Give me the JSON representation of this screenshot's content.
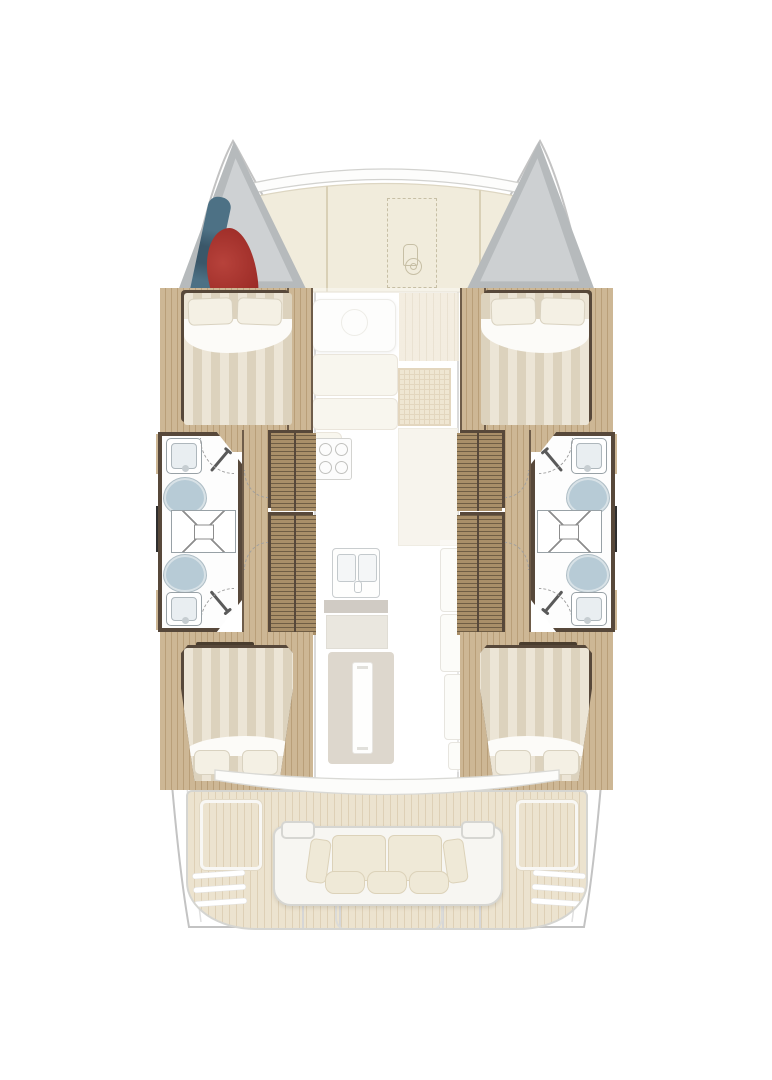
{
  "diagram": {
    "type": "floor-plan",
    "subject": "sailing-catamaran interior layout, top view, bow up",
    "hull_elements": [
      "bow-stowage-locker",
      "forward-double-berth",
      "forward-head-sink",
      "forward-toilet",
      "central-shower",
      "aft-toilet",
      "aft-head-sink",
      "wardrobe-lockers",
      "companionway-walkway",
      "aft-double-berth"
    ],
    "port_bow_locker_contents": [
      "stowed-sail-blue",
      "sail-bag-red"
    ],
    "centerline_elements": [
      "foredeck-sunpads",
      "trampoline-outline",
      "anchor-windlass",
      "forward-cockpit-table",
      "salon-settee",
      "galley-stove",
      "galley-double-sink",
      "galley-counter",
      "dining-table-with-leaf",
      "storage-cabinets",
      "aft-cockpit-bench",
      "engine-hatches",
      "transom-steps",
      "swim-platforms"
    ],
    "counts": {
      "cabins": 4,
      "toilets": 4,
      "sinks": 4,
      "showers": 2,
      "double_beds": 4,
      "bench_seat_cushions": 3,
      "bench_back_cushions": 2
    }
  },
  "colors": {
    "hull_outline": "#c3c3c3",
    "hull_seam": "#e0e0e0",
    "hull_fill": "#ffffff",
    "bow_locker": "#b6babc",
    "bow_locker_inner": "#ced1d3",
    "sail_bag_red": "#9e2d28",
    "sail_bag_red_dark": "#76201c",
    "gear_blue": "#4d7185",
    "gear_blue_dark": "#3a5769",
    "sunpad": "#f1ecdc",
    "sunpad_line": "#d9d0b6",
    "dash_outline": "#c7bfa5",
    "teak": "#e9dec6",
    "teak_line": "#d8c8a9",
    "wood": "#cdb795",
    "wood_line": "#b99f79",
    "dark_wood": "#57483a",
    "dark_wood_edge": "#6e5c49",
    "wardrobe": "#a98f69",
    "wardrobe_line": "#6f5d44",
    "bed_a": "#ece5d6",
    "bed_b": "#dcd2bd",
    "linen": "#fcfbf8",
    "pillow": "#f4f0e4",
    "pillow_edge": "#d9d2c0",
    "bath": "#fdfdfd",
    "fixture_edge": "#98a1a6",
    "basin": "#e9eef1",
    "toilet": "#b7cbd6",
    "toilet_rim": "#d8e2e7",
    "shower_line": "#8d8d8d",
    "black_locker": "#2e2e2e",
    "ghost_panel": "#f4f0e4",
    "ghost_edge": "#ddd6c6",
    "ghost_grid": "#e6d7b6",
    "ghost_grid_line": "#d2bd96",
    "table_gray": "#c9bfae",
    "counter_dark": "#b3aca0",
    "cushion": "#efe9d7",
    "cushion_edge": "#dcd2b9",
    "white_trim": "#f7f6f2",
    "trim_edge": "#d6d6d2"
  }
}
